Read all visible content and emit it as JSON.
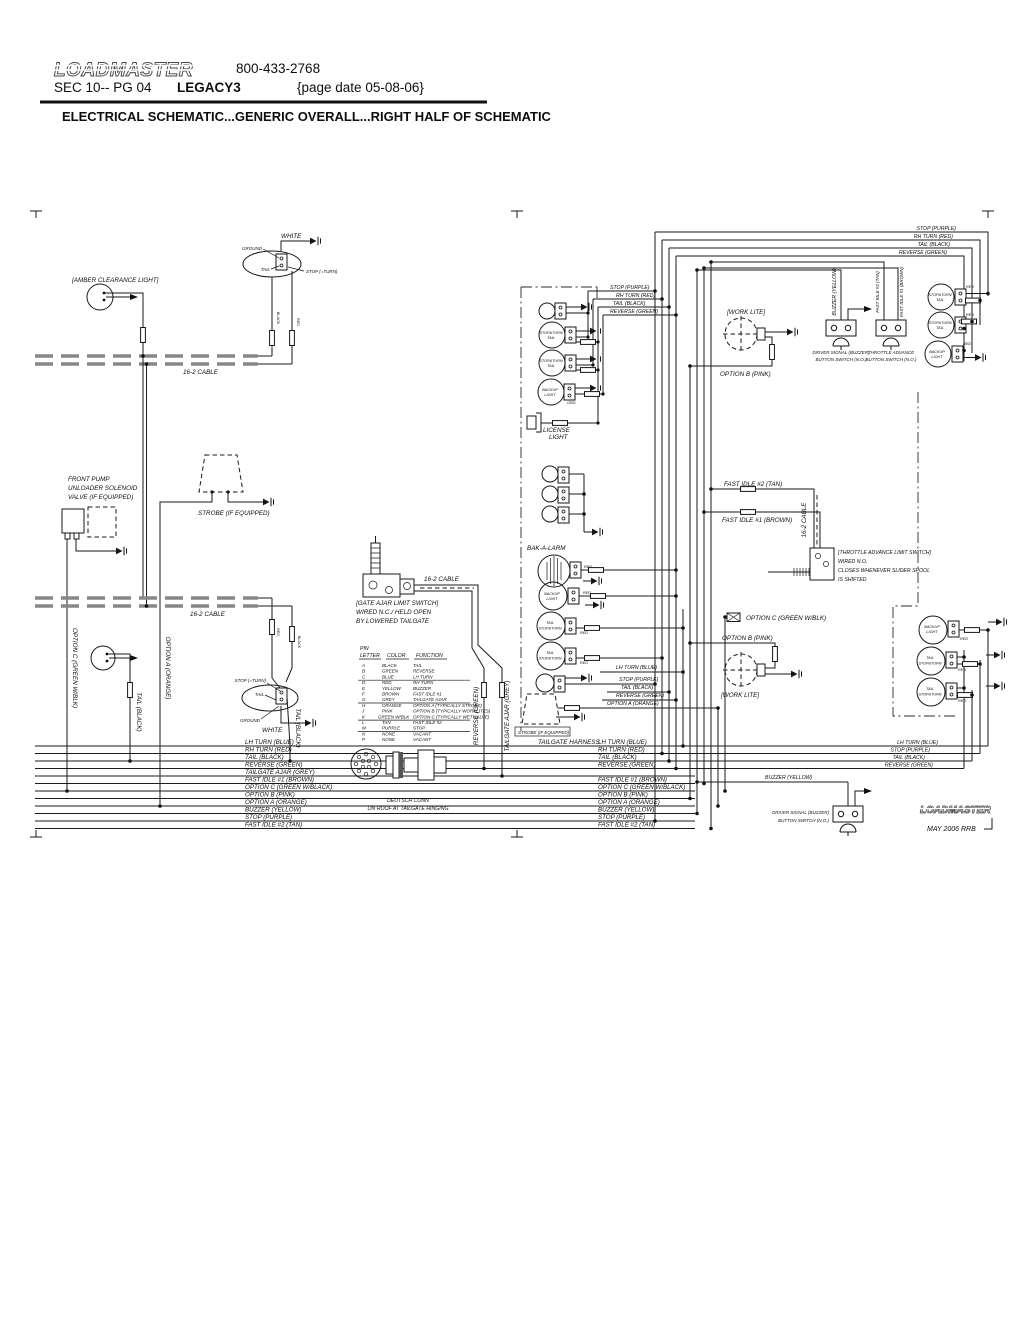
{
  "header": {
    "logo": "LOADMASTER",
    "phone": "800-433-2768",
    "sec_pg": "SEC 10-- PG 04",
    "model": "LEGACY3",
    "page_date": "{page date 05-08-06}",
    "title": "ELECTRICAL SCHEMATIC...GENERIC OVERALL...RIGHT HALF OF SCHEMATIC"
  },
  "footer": {
    "logo": "LOADMASTER",
    "revision": "MAY 2006   RRB"
  },
  "sch": {
    "labels": {
      "amber": "[AMBER CLEARANCE LIGHT]",
      "white": "WHITE",
      "ground": "GROUND",
      "tail": "TAIL",
      "stop_eq": "STOP (=TURN)",
      "red": "RED",
      "black": "BLACK",
      "cable16": "16-2 CABLE",
      "pump1": "FRONT PUMP",
      "pump2": "UNLOADER SOLENOID",
      "pump3": "VALVE (IF EQUIPPED)",
      "strobe": "STROBE (IF EQUIPPED)",
      "opt_c": "OPTION C (GREEN W/BLK)",
      "opt_a": "OPTION A (ORANGE)",
      "tail_blk": "TAIL (BLACK)",
      "gate1": "[GATE AJAR LIMIT SWITCH]",
      "gate2": "WIRED N.C./ HELD OPEN",
      "gate3": "BY LOWERED TAILGATE",
      "deutsch1": "DEUTSCH CONN",
      "deutsch2": "ON ROOF AT TAILGATE HINGING",
      "rev_grn": "REVERSE (GREEN)",
      "tg_ajar": "TAILGATE AJAR (GREY)",
      "harness": "TAILGATE HARNESS",
      "bakalarm": "BAK-A-LARM",
      "lic1": "LICENSE",
      "lic2": "LIGHT",
      "bkp1": "BACKUP",
      "bkp2": "LIGHT",
      "stopturn": "STOP&TURN",
      "grd": "GRD",
      "worklite": "[WORK LITE]",
      "opt_b": "OPTION B (PINK)",
      "buzzer": "BUZZER (YELLOW)",
      "drv1": "DRIVER SIGNAL (BUZZER)",
      "drv2": "BUTTON SWITCH (N.O.)",
      "thr1": "THROTTLE ADVANCE",
      "fi2": "FAST IDLE #2 (TAN)",
      "fi1": "FAST IDLE #1 (BROWN)",
      "tal1": "[THROTTLE ADVANCE LIMIT SWITCH]",
      "tal2": "WIRED N.O.",
      "tal3": "CLOSES WHENEVER SLIDER SPOOL",
      "tal4": "IS SHIFTED"
    },
    "top_right": [
      "STOP (PURPLE)",
      "RH TURN (RED)",
      "TAIL (BLACK)",
      "REVERSE (GREEN)"
    ],
    "mid_top": [
      "STOP (PURPLE)",
      "RH TURN (RED)",
      "TAIL (BLACK)",
      "REVERSE (GREEN)"
    ],
    "mid_stub": [
      "LH TURN (BLUE)",
      "STOP (PURPLE)",
      "TAIL (BLACK)",
      "REVERSE (GREEN)",
      "OPTION A (ORANGE)"
    ],
    "br_labels": [
      "LH TURN (BLUE)",
      "STOP (PURPLE)",
      "TAIL (BLACK)",
      "REVERSE (GREEN)"
    ],
    "bus_left": [
      "LH TURN (BLUE)",
      "RH TURN (RED)",
      "TAIL (BLACK)",
      "REVERSE (GREEN)",
      "TAILGATE AJAR (GREY)",
      "FAST IDLE #1 (BROWN)",
      "OPTION C (GREEN W/BLACK)",
      "OPTION B (PINK)",
      "OPTION A (ORANGE)",
      "BUZZER (YELLOW)",
      "STOP (PURPLE)",
      "FAST IDLE #2 (TAN)"
    ],
    "bus_mid": [
      "LH TURN (BLUE)",
      "RH TURN (RED)",
      "TAIL (BLACK)",
      "REVERSE (GREEN)",
      "FAST IDLE #1 (BROWN)",
      "OPTION C (GREEN W/BLACK)",
      "OPTION B (PINK)",
      "OPTION A (ORANGE)",
      "BUZZER (YELLOW)",
      "STOP (PURPLE)",
      "FAST IDLE #2 (TAN)"
    ],
    "pin_table": {
      "h_pin": "PIN",
      "h_letter": "LETTER",
      "h_color": "COLOR",
      "h_function": "FUNCTION",
      "rows": [
        [
          "A",
          "BLACK",
          "TAIL"
        ],
        [
          "B",
          "GREEN",
          "REVERSE"
        ],
        [
          "C",
          "BLUE",
          "LH TURN"
        ],
        [
          "D",
          "RED",
          "RH TURN"
        ],
        [
          "E",
          "YELLOW",
          "BUZZER"
        ],
        [
          "F",
          "BROWN",
          "FAST IDLE #1"
        ],
        [
          "G",
          "GREY",
          "TAILGATE AJAR"
        ],
        [
          "H",
          "ORANGE",
          "OPTION A (TYPICALLY STROBE)"
        ],
        [
          "J",
          "PINK",
          "OPTION B (TYPICALLY WORKLITES)"
        ],
        [
          "K",
          "GREEN W/BLK",
          "OPTION C (TYPICALLY WET VALVE)"
        ],
        [
          "L",
          "TAN",
          "FAST IDLE #2"
        ],
        [
          "M",
          "PURPLE",
          "STOP"
        ],
        [
          "N",
          "NONE",
          "VACANT"
        ],
        [
          "P",
          "NONE",
          "VACANT"
        ]
      ]
    }
  }
}
